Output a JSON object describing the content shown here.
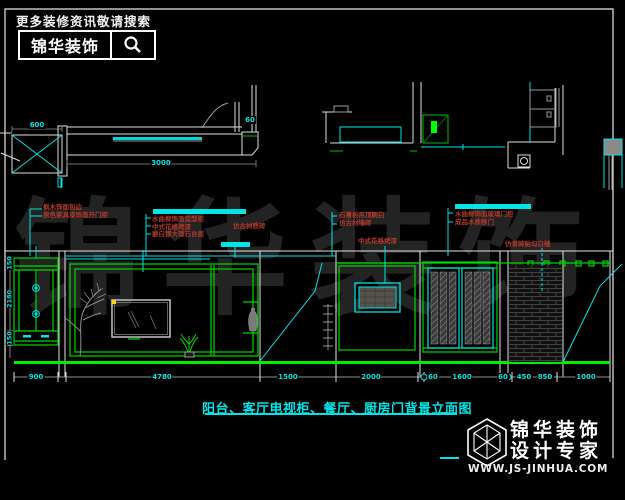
{
  "search_banner": {
    "tagline": "更多装修资讯敬请搜索",
    "brand": "锦华装饰"
  },
  "watermark": "锦华装饰",
  "drawing": {
    "caption": "阳台、客厅电视柜、餐厅、厨房门背景立面图",
    "annotations": {
      "balcony_cabinet": [
        "枫木饰面包边",
        "原色家具漆饰面开门柜"
      ],
      "tv_wall": [
        "水曲柳饰面造型柜",
        "中式花格烤漆",
        "爵白银大理石台面"
      ],
      "tile": "仿古材质砖",
      "ceiling": [
        "石膏板吊顶刷白",
        "仿古材墙砖"
      ],
      "lattice": "中式花格烤漆",
      "kitchen_door": [
        "水曲柳饰面玻璃门柜",
        "成品木质移门"
      ],
      "brick_wall": "仿青砖贴勾白缝"
    },
    "dims": {
      "plan_length": "3000",
      "plan_box": "600",
      "plan_seat": "60",
      "left": [
        "150",
        "2180",
        "150"
      ],
      "bottom": [
        "900",
        "4780",
        "1500",
        "2000",
        "60",
        "1600",
        "60",
        "450",
        "850",
        "1000"
      ]
    }
  },
  "brand_footer": {
    "name": "锦华装饰",
    "slogan": "设计专家",
    "website": "WWW.JS-JINHUA.COM"
  }
}
